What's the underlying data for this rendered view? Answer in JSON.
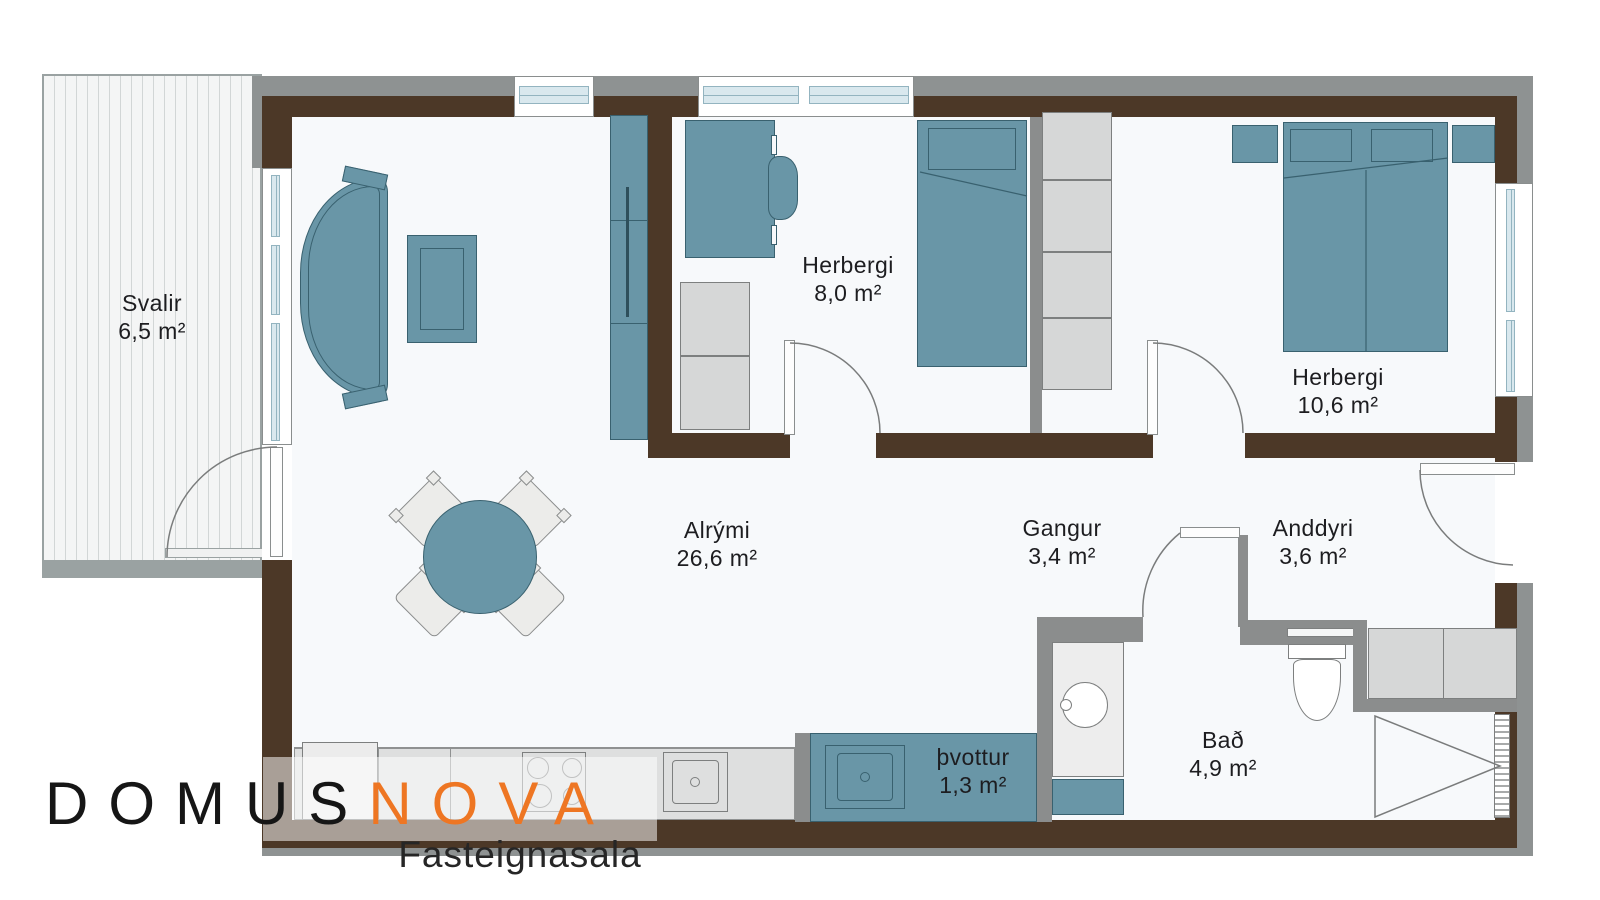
{
  "logo": {
    "brand_primary": "DOMUS",
    "brand_secondary": "NOVA",
    "tagline": "Fasteignasala"
  },
  "rooms": {
    "svalir": {
      "name": "Svalir",
      "area": "6,5 m²"
    },
    "herbergi_small": {
      "name": "Herbergi",
      "area": "8,0 m²"
    },
    "herbergi_large": {
      "name": "Herbergi",
      "area": "10,6 m²"
    },
    "alrymi": {
      "name": "Alrými",
      "area": "26,6 m²"
    },
    "gangur": {
      "name": "Gangur",
      "area": "3,4 m²"
    },
    "anddyri": {
      "name": "Anddyri",
      "area": "3,6 m²"
    },
    "bad": {
      "name": "Bað",
      "area": "4,9 m²"
    },
    "thvottur": {
      "name": "þvottur",
      "area": "1,3 m²"
    }
  },
  "furniture_icons": [
    "sofa-icon",
    "coffee-table-icon",
    "tall-cabinet-icon",
    "dining-table-icon",
    "dining-chair-icon",
    "desk-icon",
    "desk-chair-icon",
    "single-bed-icon",
    "double-bed-icon",
    "nightstand-icon",
    "closet-icon",
    "cabinet-icon",
    "kitchen-counter-icon",
    "fridge-icon",
    "stove-icon",
    "sink-icon",
    "laundry-sink-icon",
    "washbasin-icon",
    "toilet-icon",
    "bench-icon",
    "shower-icon",
    "window-icon",
    "door-icon"
  ],
  "colors": {
    "wall_brown": "#4c3827",
    "outer_gray": "#8e9292",
    "partition_gray": "#8b8d8d",
    "furniture_teal": "#6996a7",
    "furniture_outline": "#39616f",
    "cabinet_gray": "#d6d7d7",
    "floor": "#f7f9fb",
    "glass_blue": "#d9e8ee",
    "logo_black": "#161616",
    "logo_orange": "#ee7623"
  }
}
